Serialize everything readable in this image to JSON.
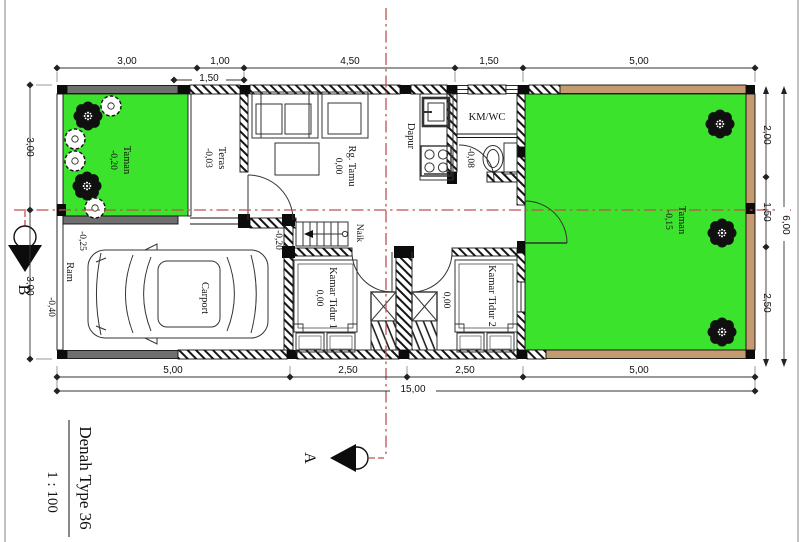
{
  "title": {
    "text": "Denah Type 36",
    "scale": "1 : 100"
  },
  "section_markers": {
    "a": "A",
    "b": "B"
  },
  "colors": {
    "green": "#3ce32c",
    "tan": "#c49a71",
    "red": "#c0504d",
    "gray": "#6f6f6f"
  },
  "rooms": {
    "taman_left": {
      "name": "Taman",
      "level": "-0,20"
    },
    "teras": {
      "name": "Teras",
      "level": "-0,03"
    },
    "rg_tamu": {
      "name": "Rg. Tamu",
      "level": "0,00"
    },
    "dapur": {
      "name": "Dapur"
    },
    "km_wc": {
      "name": "KM/WC",
      "level": "-0,08"
    },
    "kamar_tidur_1": {
      "name": "Kamar Tidur 1",
      "level": "0,00"
    },
    "kamar_tidur_2": {
      "name": "Kamar Tidur 2"
    },
    "hall": {
      "level": "0,00"
    },
    "taman_right": {
      "name": "Taman",
      "level": "-0,15"
    },
    "carport": {
      "name": "Carport",
      "level": "-0,20"
    },
    "ram": {
      "name": "Ram",
      "level": "-0,25",
      "level_outer": "-0,40"
    },
    "stairs": {
      "name": "Naik"
    }
  },
  "dimensions": {
    "top": [
      "3,00",
      "1,00",
      "4,50",
      "1,50",
      "5,00"
    ],
    "top_sub": "1,50",
    "bottom": [
      "5,00",
      "2,50",
      "2,50",
      "5,00"
    ],
    "bottom_total": "15,00",
    "left": [
      "3,00",
      "3,00"
    ],
    "right": [
      "2,00",
      "1,50",
      "2,50"
    ],
    "right_total": "6,00"
  }
}
